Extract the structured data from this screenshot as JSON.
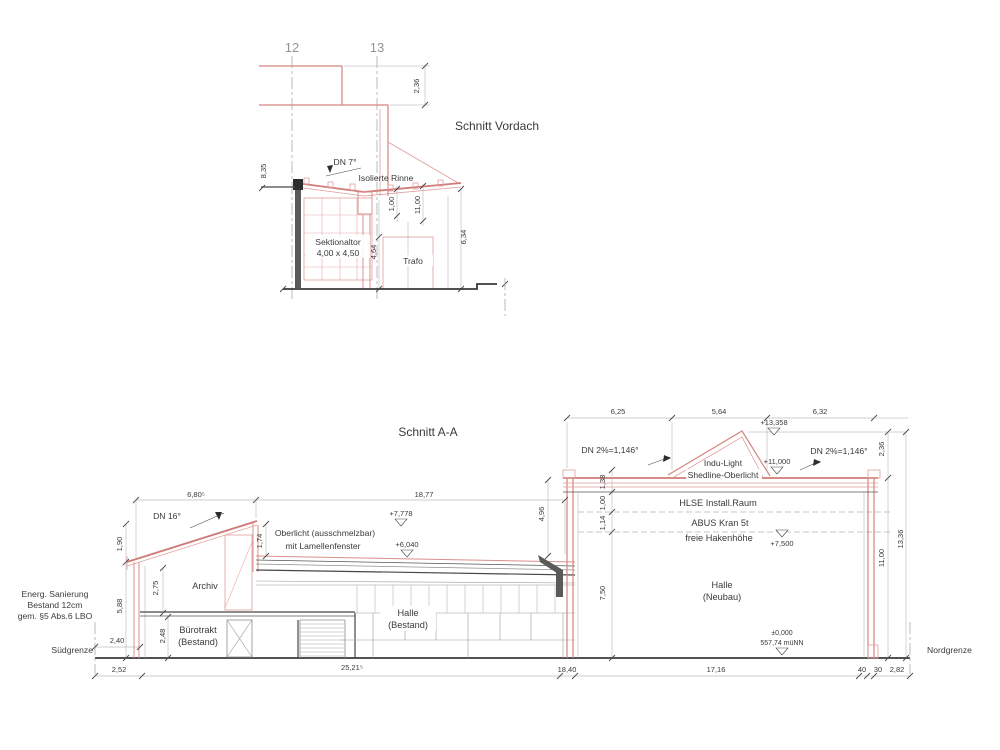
{
  "vordach": {
    "title": "Schnitt Vordach",
    "grid_labels": [
      "12",
      "13"
    ],
    "labels": {
      "dn": "DN 7°",
      "rinne": "Isolierte Rinne",
      "tor1": "Sektionaltor",
      "tor2": "4,00 x 4,50",
      "trafo": "Trafo"
    },
    "dims": {
      "top_right": "2,36",
      "left": "8,35",
      "gutter": "1,00",
      "canopy": "11,00",
      "trafo": "4,64",
      "right": "6,34"
    }
  },
  "schnitt_aa": {
    "title": "Schnitt A-A",
    "notes": {
      "line1": "Energ. Sanierung",
      "line2": "Bestand 12cm",
      "line3": "gem. §5 Abs.6 LBO"
    },
    "boundaries": {
      "south": "Südgrenze",
      "north": "Nordgrenze"
    },
    "rooms": {
      "archiv": "Archiv",
      "buero1": "Bürotrakt",
      "buero2": "(Bestand)",
      "halle_b1": "Halle",
      "halle_b2": "(Bestand)",
      "halle_n1": "Halle",
      "halle_n2": "(Neubau)"
    },
    "annotations": {
      "dn_left": "DN 16°",
      "oberlicht1": "Oberlicht (ausschmelzbar)",
      "oberlicht2": "mit Lamellenfenster",
      "dn2_left": "DN 2%=1,146°",
      "dn2_right": "DN 2%=1,146°",
      "indu1": "Indu-Light",
      "indu2": "Shedline-Oberlicht",
      "hlse": "HLSE Install.Raum",
      "kran": "ABUS Kran 5t",
      "haken": "freie Hakenhöhe"
    },
    "levels": {
      "peak": "+13,358",
      "roof": "+11,000",
      "oberlicht_top": "+7,778",
      "bestand_roof": "+6,040",
      "hook": "+7,500",
      "zero1": "±0,000",
      "zero2": "557,74 müNN"
    },
    "dims": {
      "top": [
        "6,25",
        "5,64",
        "6,32"
      ],
      "right_upper": "2,36",
      "right_wall": "11,00",
      "right_total": "13,36",
      "roof_left": "6,80⁵",
      "roof_main": "18,77",
      "left_rise": "1,90",
      "left_wall": "5,88",
      "archiv_h": "2,75",
      "buero_h": "2,48",
      "setback": "2,40",
      "oberlicht_h": "1,74",
      "junction": "4,96",
      "stack": [
        "1,38",
        "1,00",
        "1,14"
      ],
      "hall_h": "7,50",
      "bottom": [
        "2,52",
        "25,21⁵",
        "18,40",
        "17,16",
        "40",
        "30",
        "2,82"
      ]
    }
  }
}
